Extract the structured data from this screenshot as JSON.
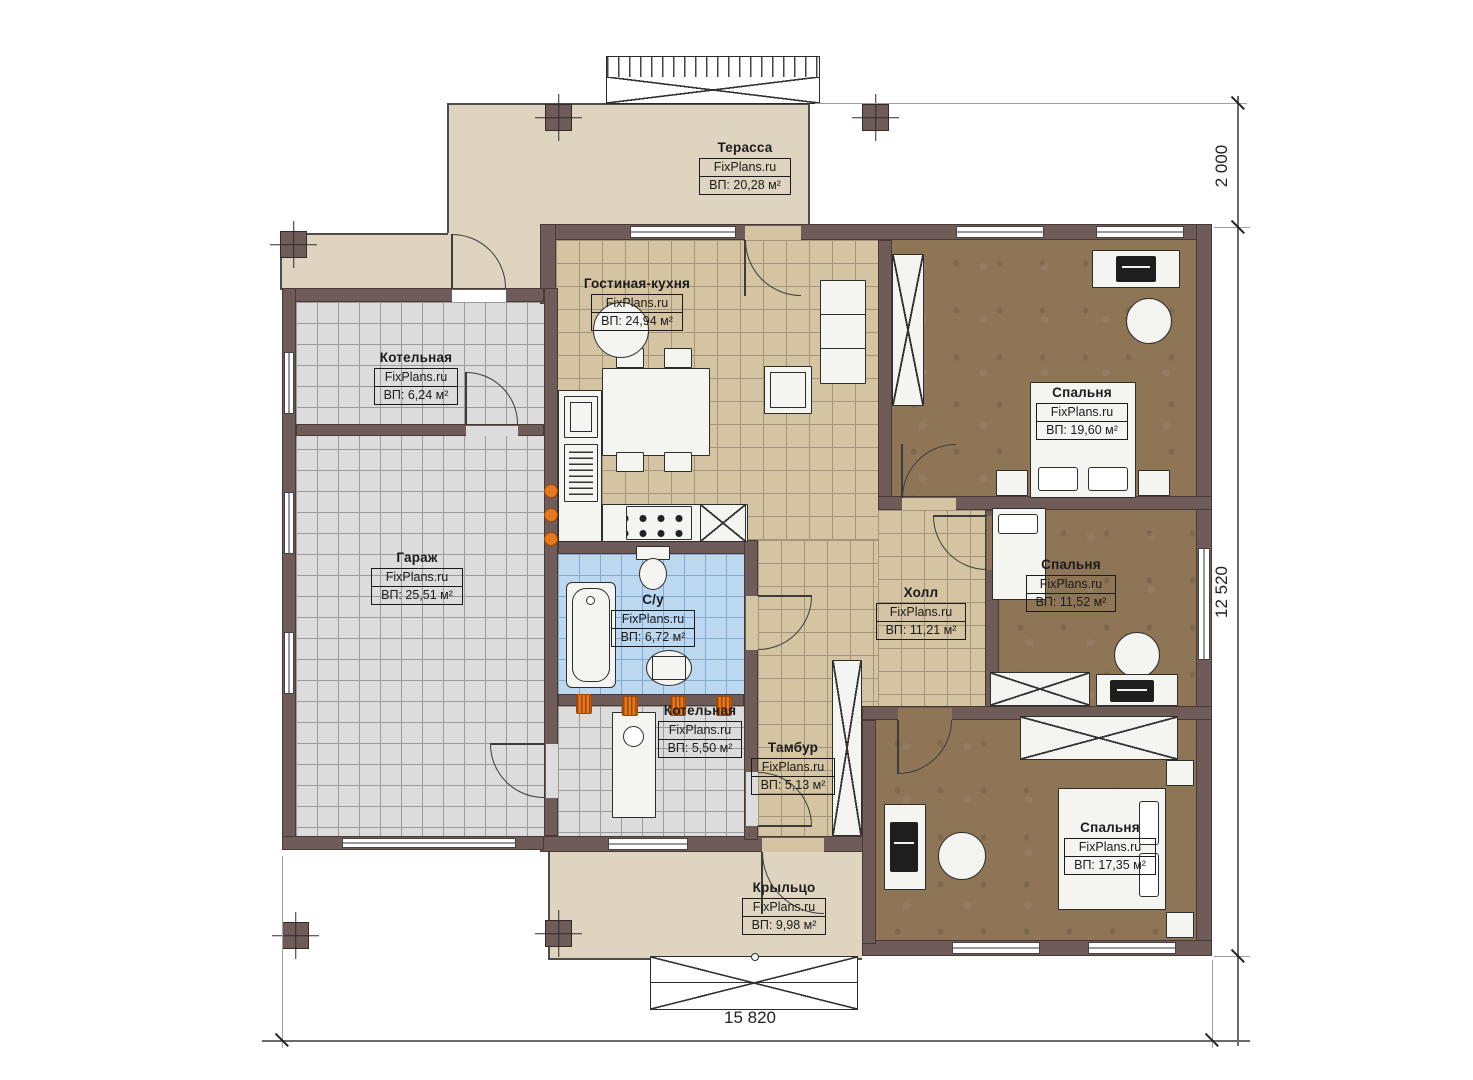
{
  "watermark": "FixPlans.ru",
  "rooms": [
    {
      "id": "terrace",
      "name": "Терасса",
      "brand": "FixPlans.ru",
      "area": "ВП: 20,28 м²"
    },
    {
      "id": "living-kitchen",
      "name": "Гостиная-кухня",
      "brand": "FixPlans.ru",
      "area": "ВП: 24,94 м²"
    },
    {
      "id": "boiler-top",
      "name": "Котельная",
      "brand": "FixPlans.ru",
      "area": "ВП: 6,24 м²"
    },
    {
      "id": "garage",
      "name": "Гараж",
      "brand": "FixPlans.ru",
      "area": "ВП: 25,51 м²"
    },
    {
      "id": "bedroom-1",
      "name": "Спальня",
      "brand": "FixPlans.ru",
      "area": "ВП: 19,60 м²"
    },
    {
      "id": "bedroom-2",
      "name": "Спальня",
      "brand": "FixPlans.ru",
      "area": "ВП: 11,52 м²"
    },
    {
      "id": "hall",
      "name": "Холл",
      "brand": "FixPlans.ru",
      "area": "ВП: 11,21 м²"
    },
    {
      "id": "bathroom",
      "name": "С/у",
      "brand": "FixPlans.ru",
      "area": "ВП: 6,72 м²"
    },
    {
      "id": "boiler-bottom",
      "name": "Котельная",
      "brand": "FixPlans.ru",
      "area": "ВП: 5,50 м²"
    },
    {
      "id": "tambour",
      "name": "Тамбур",
      "brand": "FixPlans.ru",
      "area": "ВП: 5,13 м²"
    },
    {
      "id": "bedroom-3",
      "name": "Спальня",
      "brand": "FixPlans.ru",
      "area": "ВП: 17,35 м²"
    },
    {
      "id": "porch",
      "name": "Крыльцо",
      "brand": "FixPlans.ru",
      "area": "ВП: 9,98 м²"
    }
  ],
  "dimensions": {
    "right_top": "2 000",
    "right_main": "12 520",
    "bottom_total": "15 820"
  },
  "colors": {
    "wall": "#6f5b57",
    "floor_terrace": "#ded4bf",
    "floor_tile_tan": "#d4c4a2",
    "floor_tile_gray": "#dcdcdc",
    "floor_tile_blue": "#bcd8f0",
    "floor_bedroom_brown": "#8d7556",
    "fixture_orange": "#e6781e"
  }
}
